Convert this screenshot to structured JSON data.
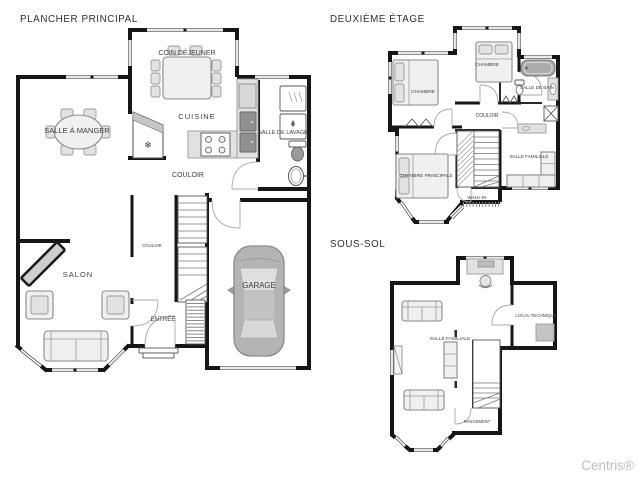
{
  "watermark": {
    "text": "Centris®",
    "color": "#bdbdbd"
  },
  "icons": {
    "snowflake": "❄"
  },
  "colors": {
    "wall": "#161616",
    "furniture_fill": "#f0f0f0",
    "appliance_dark": "#909090",
    "car_body": "#b4b4b4",
    "label": "#3d3d3d",
    "watermark": "#bdbdbd",
    "background": "#ffffff"
  },
  "plans": {
    "main_floor": {
      "title": "PLANCHER PRINCIPAL",
      "rooms": {
        "coin_dejeuner": "COIN DÉJEUNER",
        "cuisine": "CUISINE",
        "salle_a_manger": "SALLE À MANGER",
        "salle_de_lavage": "SALLE DE LAVAGE",
        "couloir": "COULOIR",
        "couloir_2": "COULOIR",
        "salon": "SALON",
        "entree": "ENTRÉE",
        "garage": "GARAGE"
      }
    },
    "second_floor": {
      "title": "DEUXIÈME ÉTAGE",
      "rooms": {
        "chambre_1": "CHAMBRE",
        "chambre_2": "CHAMBRE",
        "salle_de_bain": "SALLE DE BAIN",
        "couloir": "COULOIR",
        "chambre_principale": "CHAMBRE PRINCIPALE",
        "salle_familiale": "SALLE FAMILIALE",
        "walk_in": "WALK-IN"
      }
    },
    "basement": {
      "title": "SOUS-SOL",
      "rooms": {
        "salle_familiale": "SALLE FAMILIALE",
        "local_technique": "LOCAL TECHNIQUE",
        "rangement": "RANGEMENT"
      }
    }
  }
}
